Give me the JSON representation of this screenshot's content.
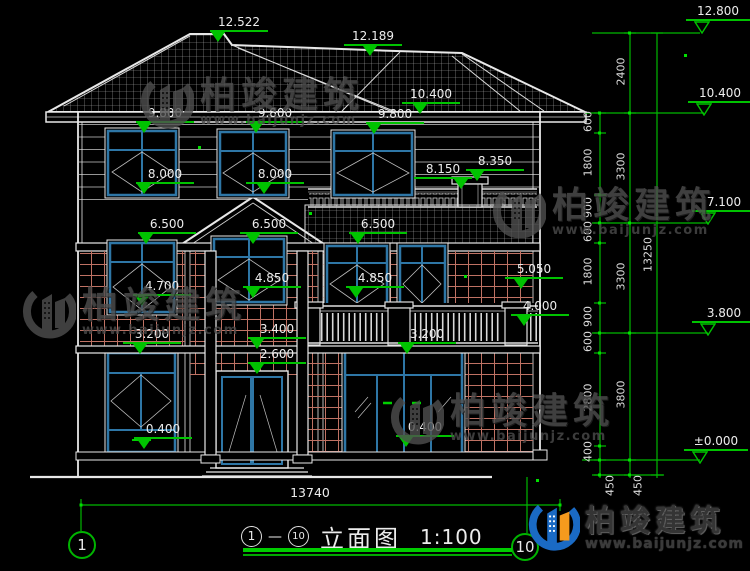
{
  "drawing_type": "elevation",
  "levels": [
    "12.522",
    "12.189",
    "10.400",
    "9.800",
    "9.800",
    "9.800",
    "8.000",
    "8.000",
    "8.150",
    "8.350",
    "6.500",
    "6.500",
    "6.500",
    "5.050",
    "4.850",
    "4.850",
    "4.700",
    "4.000",
    "3.400",
    "3.200",
    "3.200",
    "2.600",
    "0.400",
    "0.400"
  ],
  "elevations": [
    "12.800",
    "10.400",
    "7.100",
    "3.800",
    "±0.000"
  ],
  "dims": {
    "chain_a": [
      "600",
      "1800",
      "900",
      "600",
      "1800",
      "900",
      "600",
      "2800",
      "400"
    ],
    "chain_b": [
      "2400",
      "3300",
      "3300",
      "3800"
    ],
    "foundation": [
      "450",
      "450"
    ],
    "total_height": "13250",
    "total_width": "13740"
  },
  "title": {
    "axis_start": "1",
    "separator": "—",
    "axis_end": "10",
    "label": "立面图",
    "scale": "1:100"
  },
  "bubbles": {
    "left": "1",
    "right": "10"
  },
  "watermark": {
    "brand": "柏竣建筑",
    "url": "www.baijunjz.com"
  },
  "colors": {
    "background": "#000000",
    "line": "#e8e8e8",
    "dimension_green": "#00c300",
    "window_frame": "#2e76a6",
    "brick": "#bf7264",
    "watermark_gray": "#4f4f4f",
    "logo_blue": "#1a6ac4",
    "logo_orange": "#f59a1d"
  }
}
